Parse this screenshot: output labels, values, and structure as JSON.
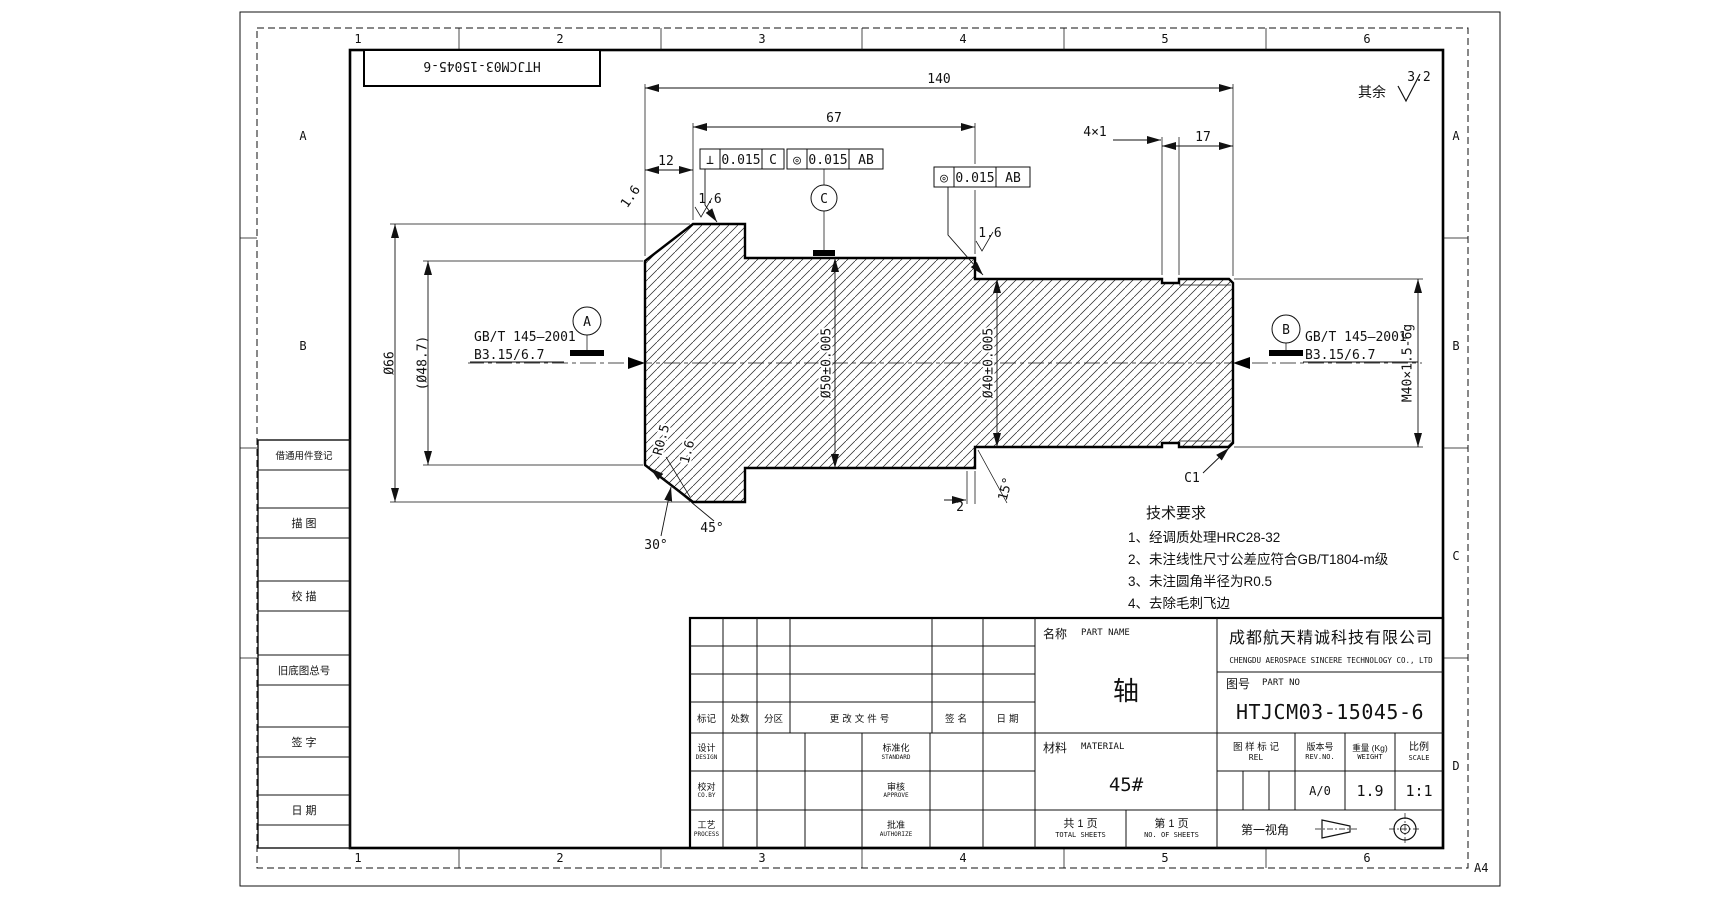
{
  "frame": {
    "zone_numbers": [
      "1",
      "2",
      "3",
      "4",
      "5",
      "6"
    ],
    "zone_letters": [
      "A",
      "B",
      "C",
      "D"
    ],
    "format": "A4",
    "mirrored_part_no": "HTJCM03-15045-6"
  },
  "sidebar": {
    "item1": "借通用件登记",
    "item2": "描 图",
    "item3": "校 描",
    "item4": "旧底图总号",
    "item5": "签 字",
    "item6": "日 期"
  },
  "dims": {
    "len140": "140",
    "len67": "67",
    "len12": "12",
    "groove": "4×1",
    "len17": "17",
    "dia66": "Ø66",
    "dia487": "(Ø48.7)",
    "dia50": "Ø50±0.005",
    "dia40": "Ø40±0.005",
    "thread": "M40×1.5-6g",
    "c1": "C1",
    "r05": "R0.5",
    "deg45": "45°",
    "deg30": "30°",
    "deg15": "15°",
    "len2": "2"
  },
  "roughness": {
    "rest_label": "其余",
    "rest_value": "3.2",
    "ra1": "1.6",
    "ra2": "1.6",
    "ra3": "1.6",
    "ra4": "1.6"
  },
  "fcf": [
    {
      "symbol": "⊥",
      "tolerance": "0.015",
      "datum": "C"
    },
    {
      "symbol": "◎",
      "tolerance": "0.015",
      "datum": "AB"
    },
    {
      "symbol": "◎",
      "tolerance": "0.015",
      "datum": "AB"
    }
  ],
  "datums": {
    "a": "A",
    "b": "B",
    "c": "C"
  },
  "center_hole": {
    "std": "GB/T 145—2001",
    "spec": "B3.15/6.7"
  },
  "tech_req": {
    "title": "技术要求",
    "items": [
      "1、经调质处理HRC28-32",
      "2、未注线性尺寸公差应符合GB/T1804-m级",
      "3、未注圆角半径为R0.5",
      "4、去除毛刺飞边"
    ]
  },
  "title_block": {
    "part_name_label": "名称",
    "part_name_label_en": "PART NAME",
    "part_name": "轴",
    "company_cn": "成都航天精诚科技有限公司",
    "company_en": "CHENGDU AEROSPACE SINCERE TECHNOLOGY CO., LTD",
    "part_no_label": "图号",
    "part_no_label_en": "PART NO",
    "part_no": "HTJCM03-15045-6",
    "material_label": "材料",
    "material_label_en": "MATERIAL",
    "material": "45#",
    "rev_mark_label": "图 样 标 记",
    "rev_mark_en": "REL",
    "version_label": "版本号",
    "version_en": "REV.NO.",
    "version": "A/0",
    "weight_label": "重量 (Kg)",
    "weight_en": "WEIGHT",
    "weight": "1.9",
    "scale_label": "比例",
    "scale_en": "SCALE",
    "scale": "1:1",
    "total_label": "共 1 页",
    "total_en": "TOTAL SHEETS",
    "sheet_label": "第 1 页",
    "sheet_en": "NO. OF SHEETS",
    "projection_label": "第一视角",
    "rev_header": [
      "标记",
      "处数",
      "分区",
      "更改文件号",
      "签名",
      "日期"
    ],
    "roles_left": [
      {
        "cn": "设计",
        "en": "DESIGN"
      },
      {
        "cn": "校对",
        "en": "CO.BY"
      },
      {
        "cn": "工艺",
        "en": "PROCESS"
      }
    ],
    "roles_right": [
      {
        "cn": "标准化",
        "en": "STANDARD"
      },
      {
        "cn": "审核",
        "en": "APPROVE"
      },
      {
        "cn": "批准",
        "en": "AUTHORIZE"
      }
    ]
  }
}
